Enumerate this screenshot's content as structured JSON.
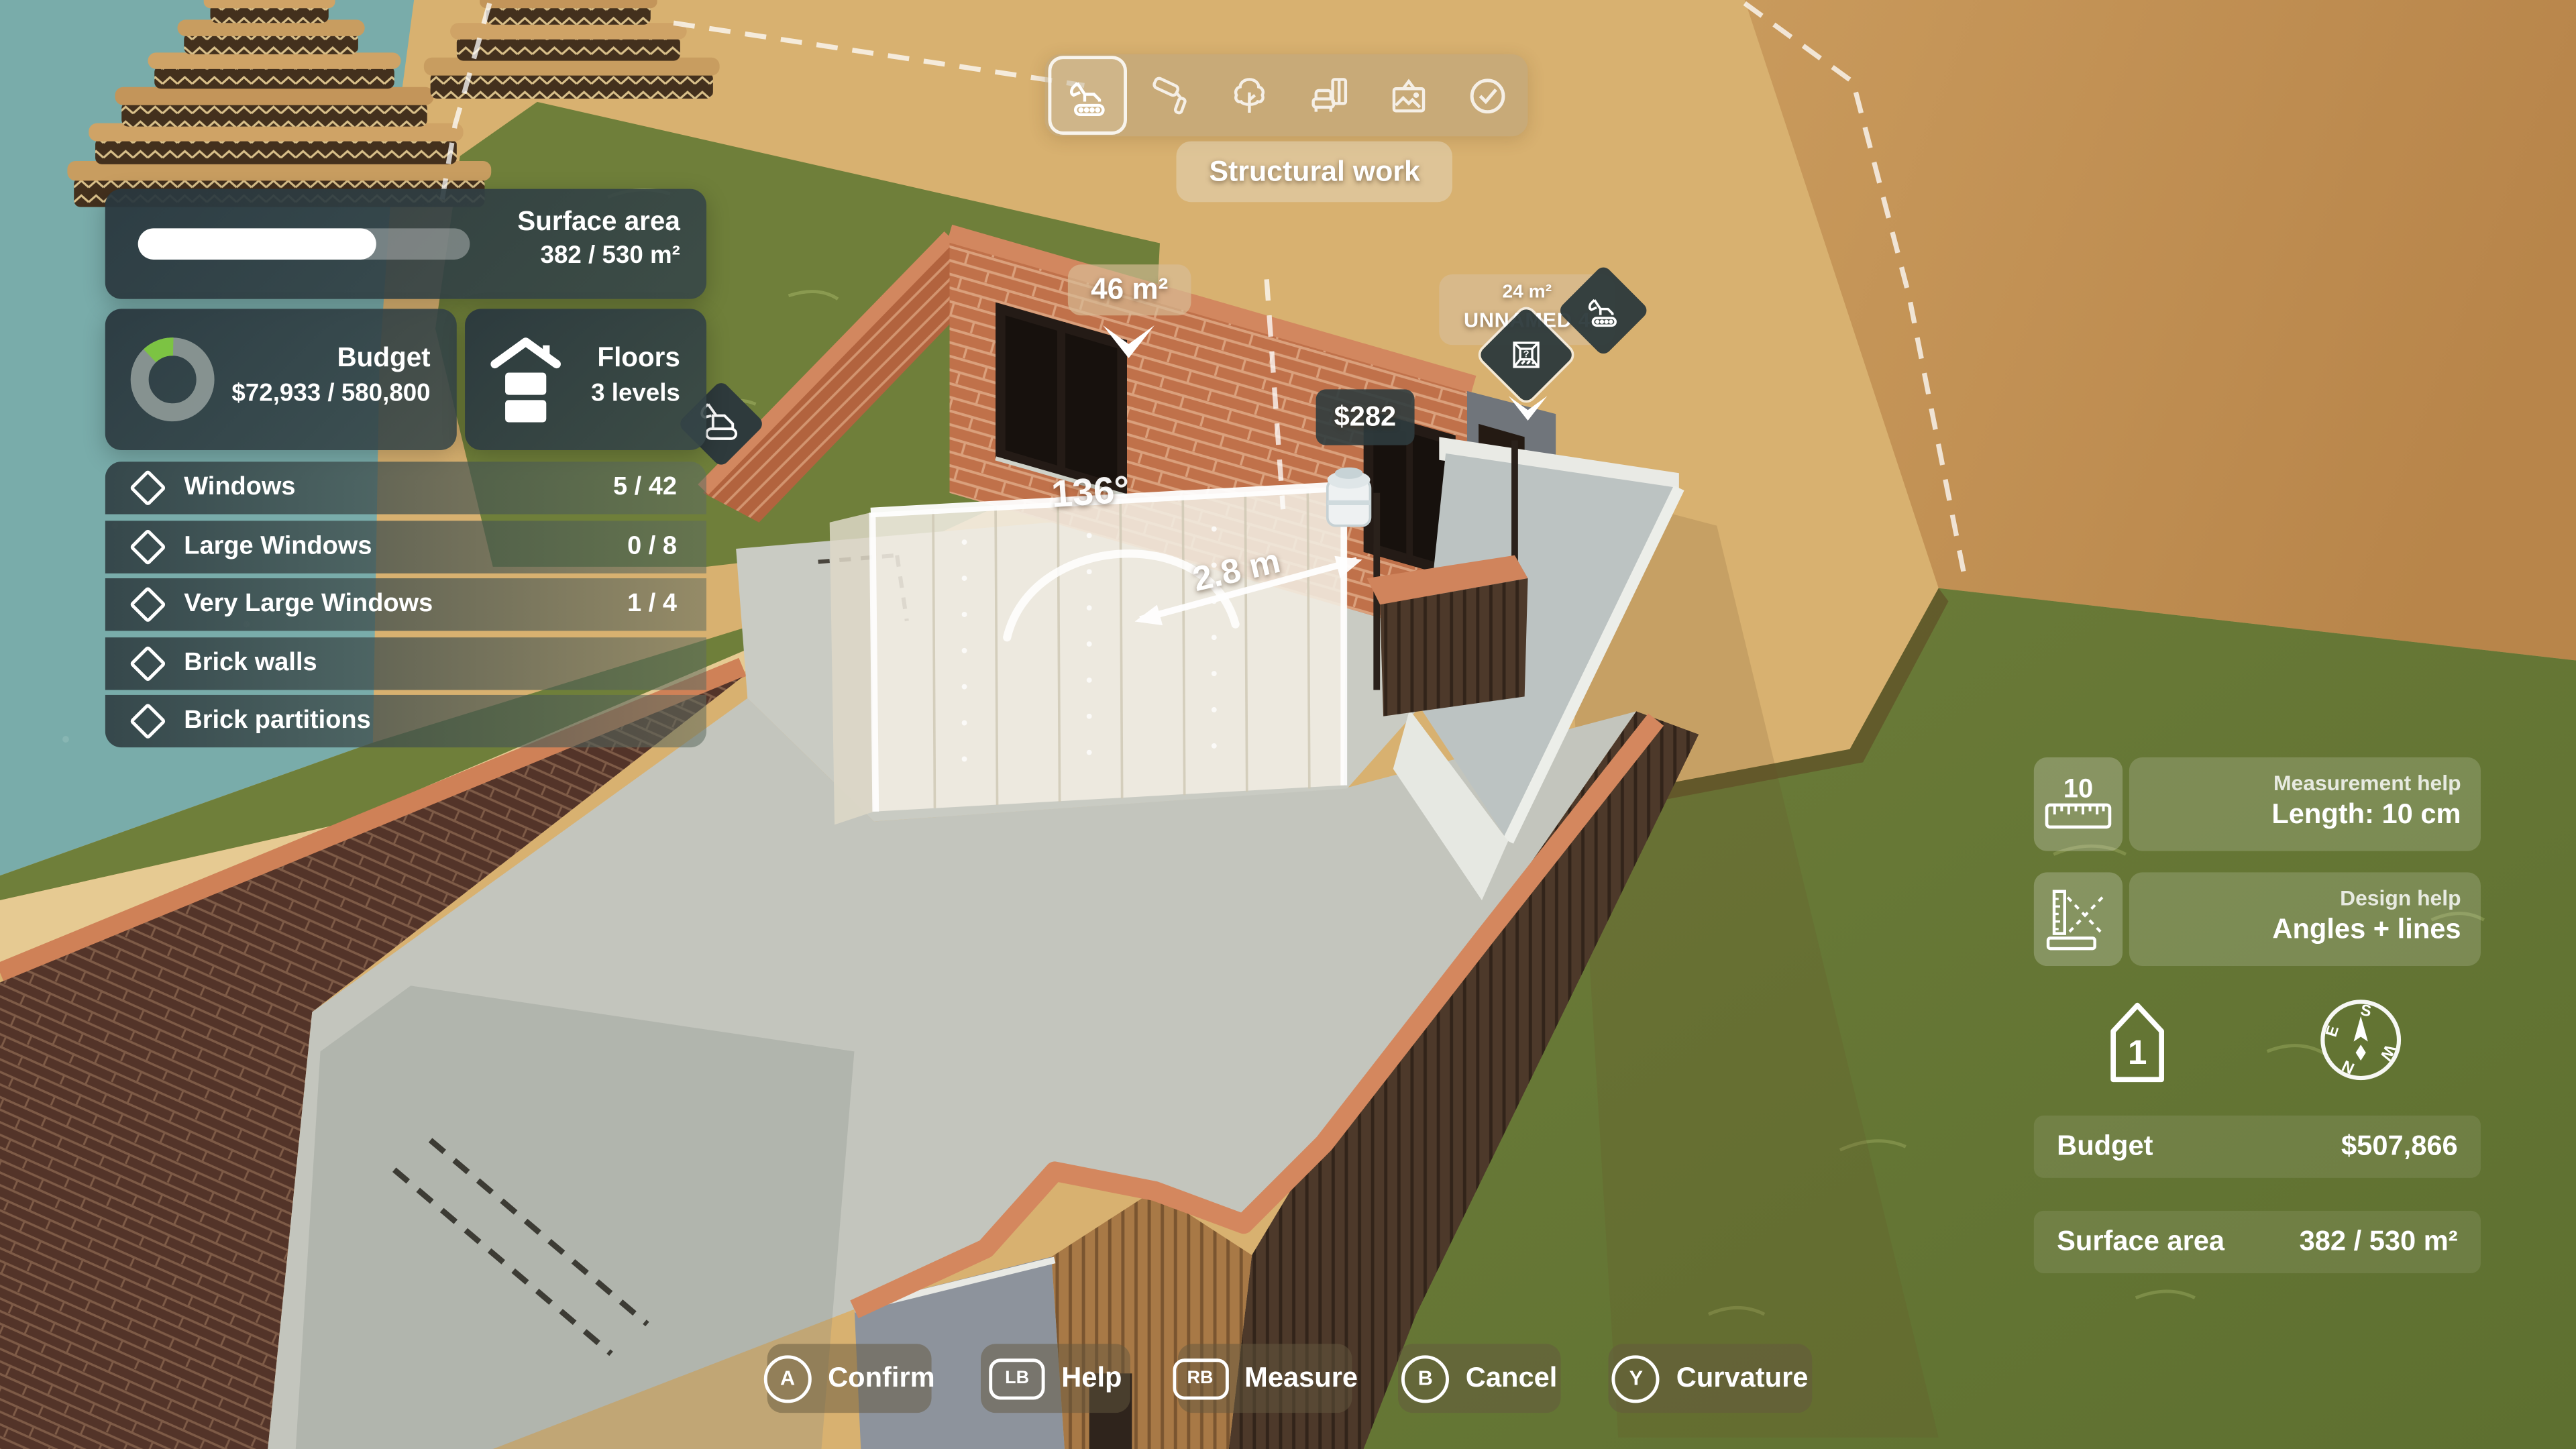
{
  "toolbar": {
    "tools": [
      {
        "name": "structural-work",
        "icon": "excavator-icon",
        "selected": true
      },
      {
        "name": "painting",
        "icon": "paint-roller-icon",
        "selected": false
      },
      {
        "name": "landscaping",
        "icon": "tree-icon",
        "selected": false
      },
      {
        "name": "furnishing",
        "icon": "sofa-icon",
        "selected": false
      },
      {
        "name": "decoration",
        "icon": "picture-frame-icon",
        "selected": false
      },
      {
        "name": "finish",
        "icon": "check-circle-icon",
        "selected": false
      }
    ],
    "active_tool_label": "Structural work"
  },
  "surface_panel": {
    "title": "Surface area",
    "value": "382 / 530 m²",
    "progress_percent": 72
  },
  "budget_panel": {
    "title": "Budget",
    "value": "$72,933 / 580,800",
    "spent_percent": 12.6
  },
  "floors_panel": {
    "title": "Floors",
    "value": "3 levels"
  },
  "requirements": [
    {
      "label": "Windows",
      "count": "5 / 42"
    },
    {
      "label": "Large Windows",
      "count": "0 / 8"
    },
    {
      "label": "Very Large Windows",
      "count": "1 / 4"
    },
    {
      "label": "Brick walls",
      "count": ""
    },
    {
      "label": "Brick partitions",
      "count": ""
    }
  ],
  "scene": {
    "room_area_tag": "46 m²",
    "price_tag": "$282",
    "room_marker_area": "24 m²",
    "room_marker_name": "UNNAMED 4",
    "angle_label": "136°",
    "length_label": "2.8 m"
  },
  "help": {
    "measurement": {
      "badge": "10",
      "title": "Measurement help",
      "value": "Length: 10 cm"
    },
    "design": {
      "title": "Design help",
      "value": "Angles + lines"
    }
  },
  "level_indicator": "1",
  "compass": {
    "n": "N",
    "s": "S",
    "e": "E",
    "w": "W"
  },
  "stats": {
    "budget": {
      "label": "Budget",
      "value": "$507,866"
    },
    "surface": {
      "label": "Surface area",
      "value": "382 / 530 m²"
    }
  },
  "controls": [
    {
      "glyph": "A",
      "label": "Confirm"
    },
    {
      "glyph": "LB",
      "label": "Help"
    },
    {
      "glyph": "RB",
      "label": "Measure"
    },
    {
      "glyph": "B",
      "label": "Cancel"
    },
    {
      "glyph": "Y",
      "label": "Curvature"
    }
  ],
  "colors": {
    "panel_dark": "#2c3b42",
    "tag_dark": "#2f3c3e",
    "accent_green": "#7cc343",
    "tan_overlay": "#d7bc97",
    "water": "#79acaa",
    "sand": "#d8b170",
    "dirt": "#c08e50",
    "grass": "#6d7d3a",
    "brick": "#c0714a",
    "progress": "#ffffff"
  }
}
